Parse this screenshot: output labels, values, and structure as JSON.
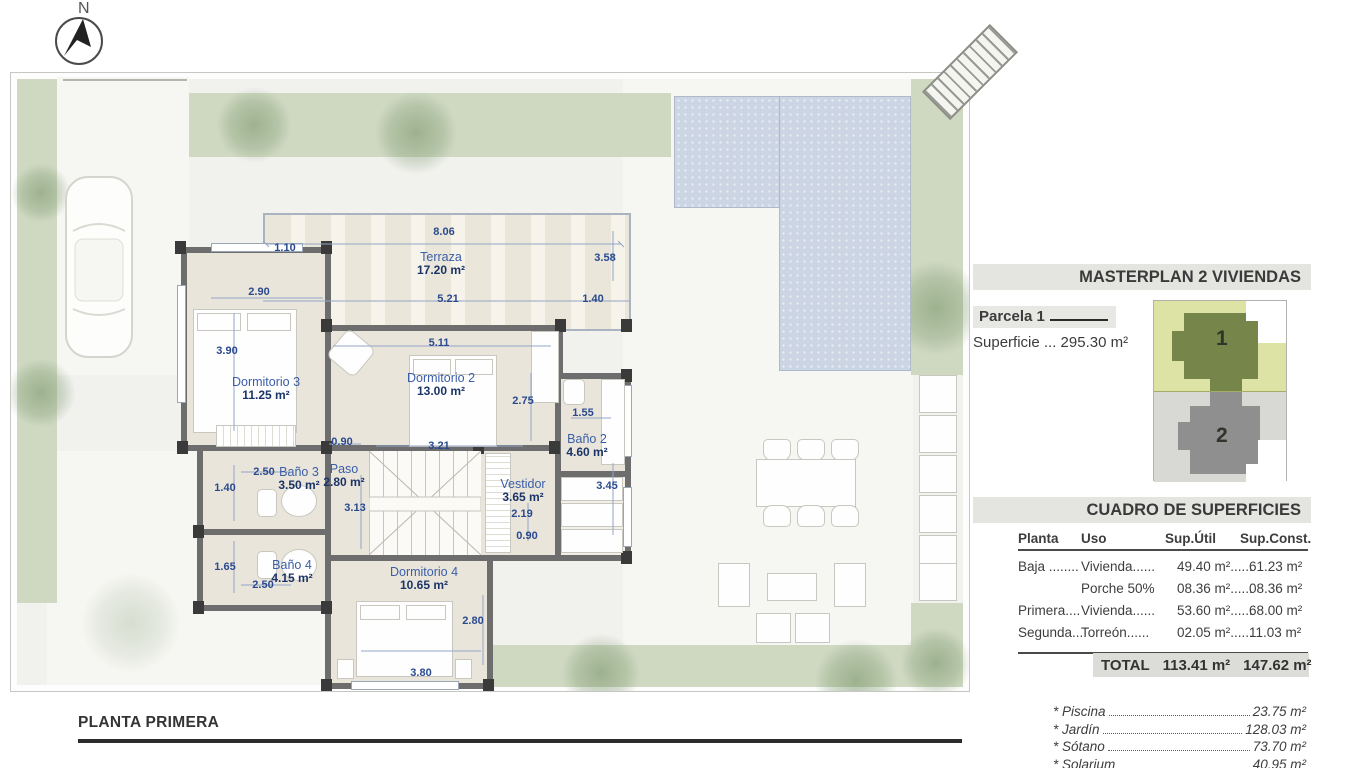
{
  "compass": {
    "north": "N"
  },
  "plan": {
    "title": "PLANTA PRIMERA",
    "rooms": {
      "terraza": {
        "name": "Terraza",
        "area": "17.20 m²"
      },
      "dorm3": {
        "name": "Dormitorio 3",
        "area": "11.25 m²"
      },
      "dorm2": {
        "name": "Dormitorio 2",
        "area": "13.00 m²"
      },
      "bano2": {
        "name": "Baño 2",
        "area": "4.60 m²"
      },
      "bano3": {
        "name": "Baño 3",
        "area": "3.50 m²"
      },
      "paso": {
        "name": "Paso",
        "area": "2.80 m²"
      },
      "vestidor": {
        "name": "Vestidor",
        "area": "3.65 m²"
      },
      "bano4": {
        "name": "Baño 4",
        "area": "4.15 m²"
      },
      "dorm4": {
        "name": "Dormitorio 4",
        "area": "10.65 m²"
      }
    },
    "dims": [
      "8.06",
      "1.10",
      "3.58",
      "2.90",
      "5.21",
      "1.40",
      "3.90",
      "5.11",
      "2.75",
      "1.55",
      "0.90",
      "3.21",
      "2.50",
      "1.40",
      "3.13",
      "3.45",
      "2.19",
      "0.90",
      "1.65",
      "2.50",
      "2.80",
      "3.80"
    ]
  },
  "panel": {
    "masterplan_title": "MASTERPLAN 2 VIVIENDAS",
    "parcela": "Parcela 1",
    "superficie": "Superficie ... 295.30 m²",
    "minimap": {
      "house1": "1",
      "house2": "2"
    },
    "cuadro": {
      "title": "CUADRO DE SUPERFICIES",
      "headers": [
        "Planta",
        "Uso",
        "Sup.Útil",
        "Sup.Const."
      ],
      "rows": [
        [
          "Baja ........",
          "Vivienda......",
          "49.40 m²......",
          "61.23 m²"
        ],
        [
          "",
          "Porche 50%",
          "08.36 m²......",
          "08.36 m²"
        ],
        [
          "Primera....",
          "Vivienda......",
          "53.60 m²......",
          "68.00 m²"
        ],
        [
          "Segunda...",
          "Torreón......",
          "02.05 m²......",
          "11.03 m²"
        ]
      ],
      "total_label": "TOTAL",
      "total_util": "113.41 m²",
      "total_const": "147.62 m²"
    },
    "extras": [
      {
        "label": "* Piscina",
        "value": "23.75 m²"
      },
      {
        "label": "* Jardín",
        "value": "128.03 m²"
      },
      {
        "label": "* Sótano",
        "value": "73.70 m²"
      },
      {
        "label": "* Solarium",
        "value": "40.95 m²"
      }
    ]
  }
}
